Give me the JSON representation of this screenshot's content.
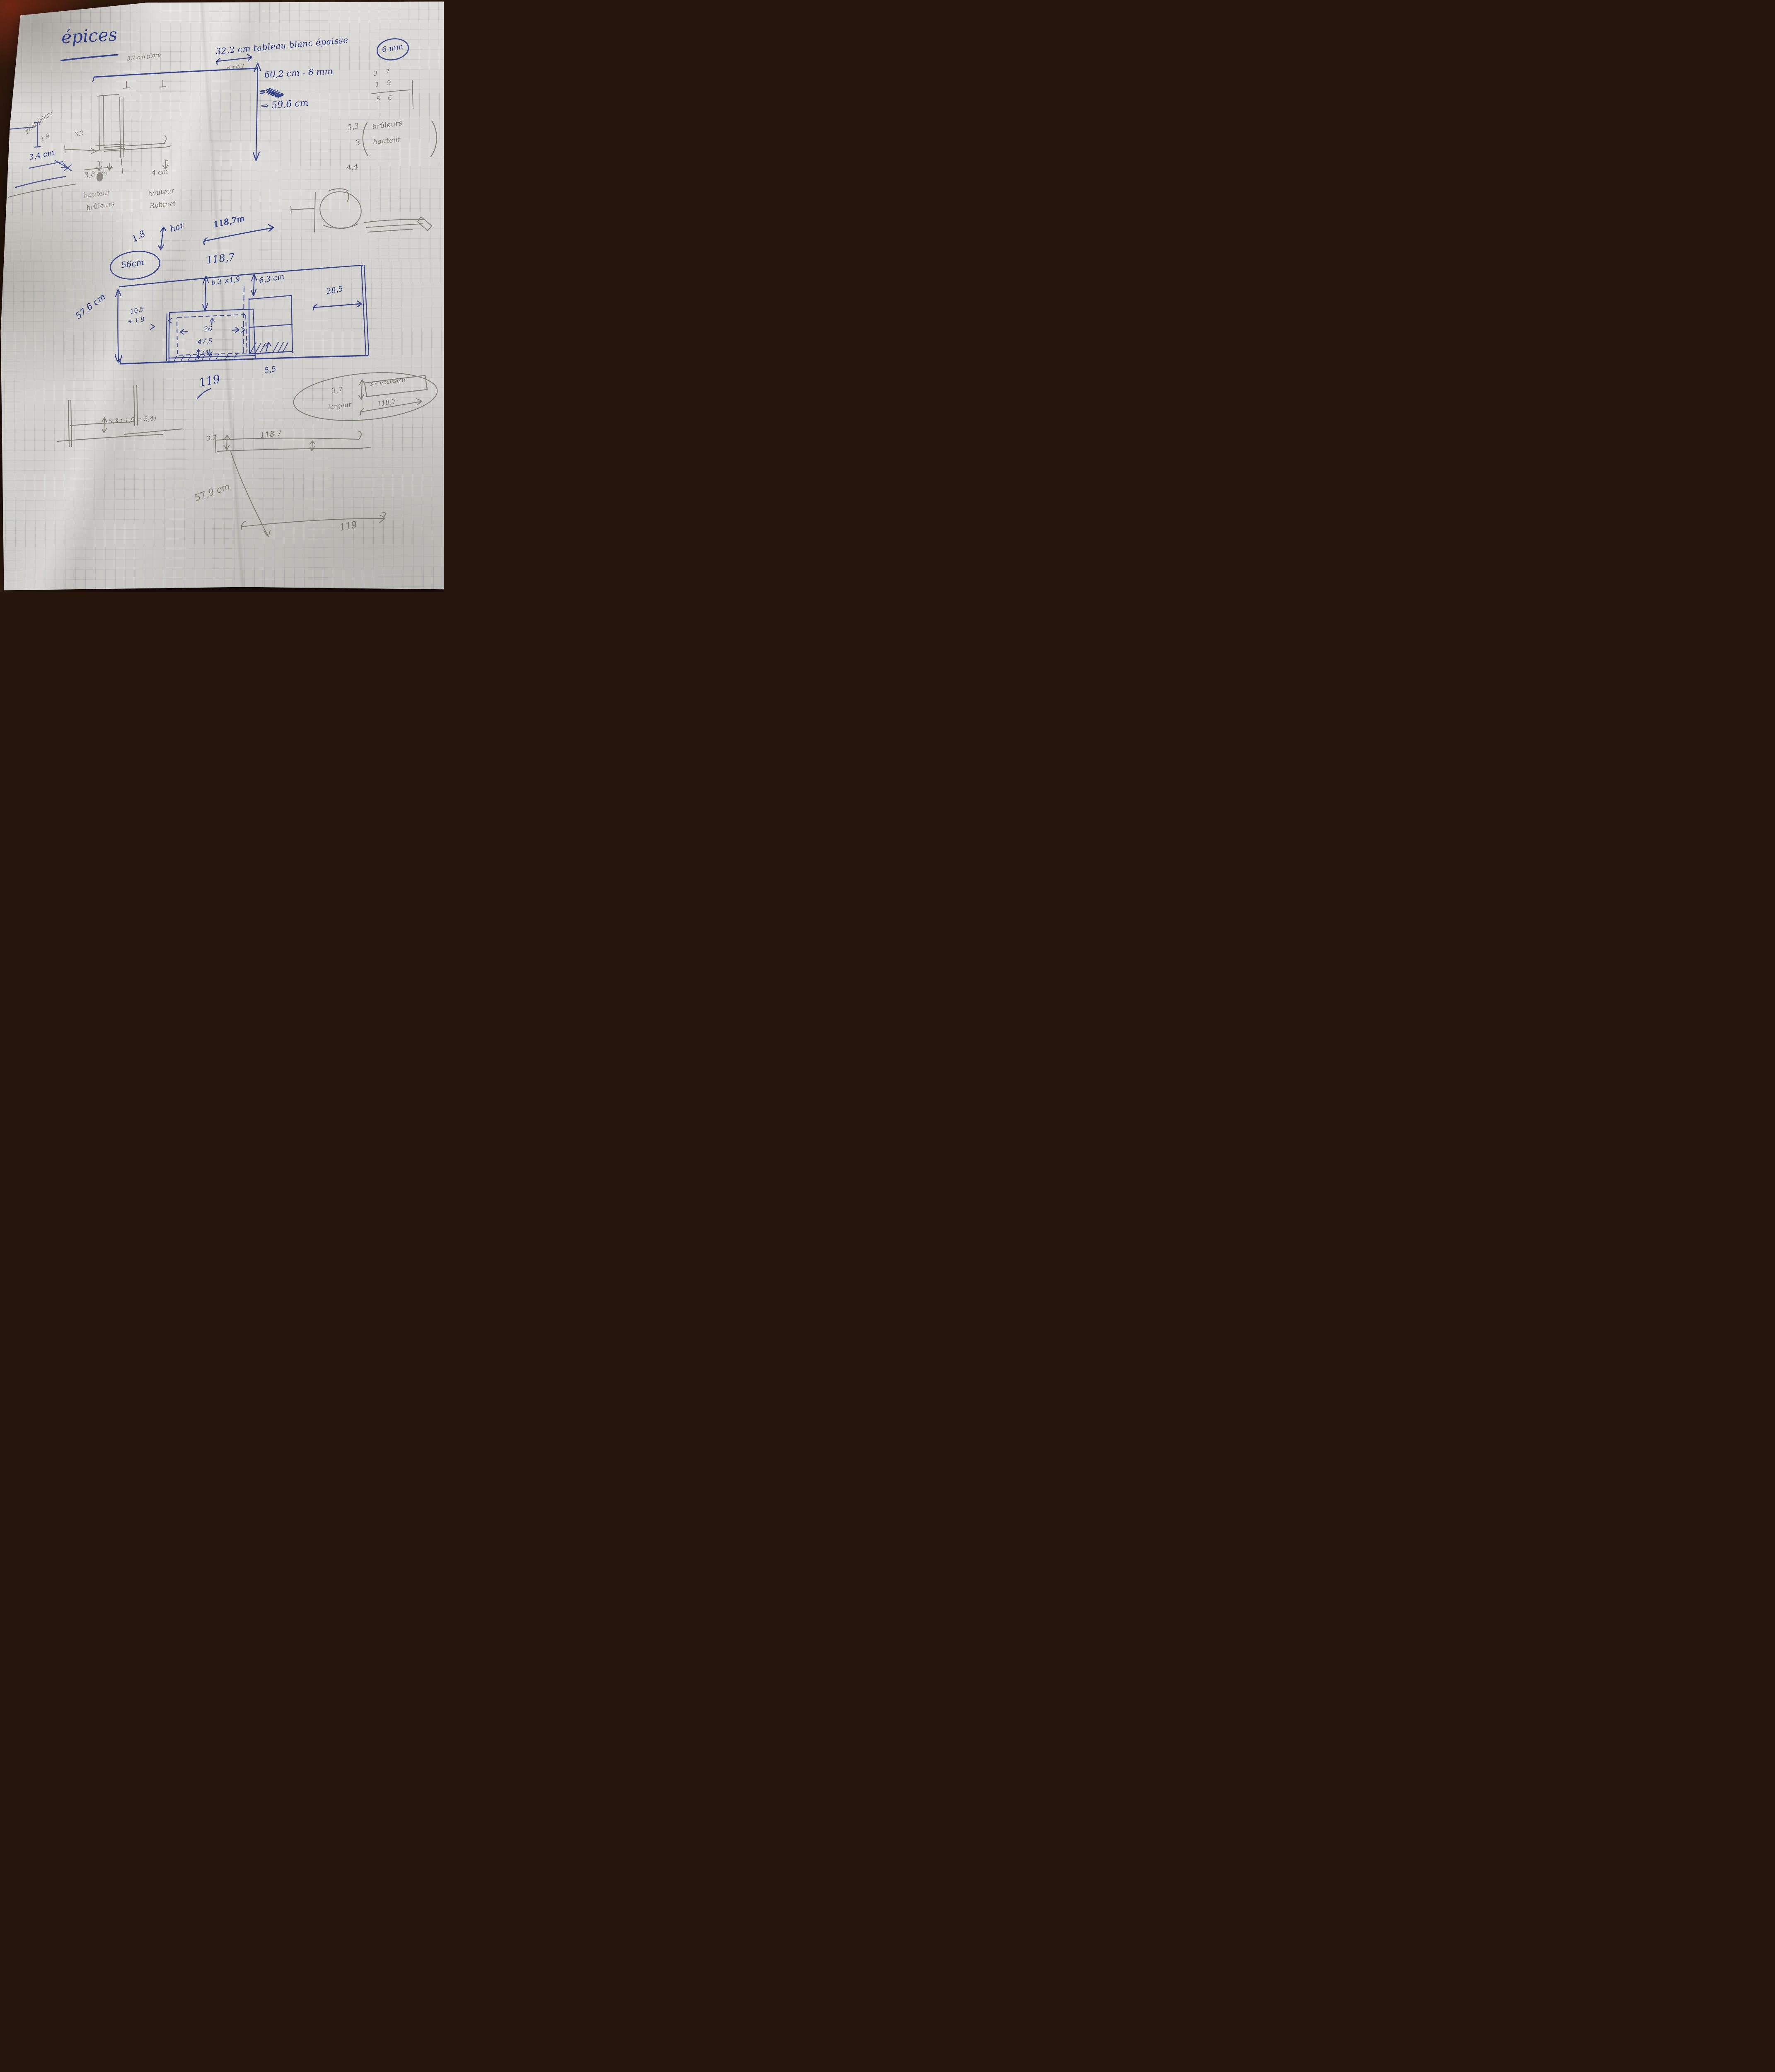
{
  "colors": {
    "ink": "#2a3784",
    "pencil": "#6b675e",
    "paper": "#d6d4d0",
    "background": "#26150c"
  },
  "title": "épices",
  "top": {
    "shelf_note": "3,7 cm plare",
    "board_note": "32,2 cm tableau blanc épaisse",
    "board_thickness": "6 mm",
    "thickness_query": "6 mm ?",
    "calc": "60,2 cm - 6 mm",
    "equals": "=",
    "result": "⇒ 59,6 cm",
    "sum_a": "3 7",
    "sum_b": "1 9",
    "sum_total": "5 6",
    "burners_value1": "3,3",
    "burners_label1": "brûleurs",
    "burners_value2": "3",
    "burners_label2": "hauteur"
  },
  "left_detail": {
    "joint_label": "joint faêtre",
    "joint_value": "1,9",
    "gap_value": "3,2",
    "edge_value": "3,4 cm",
    "burner_height": "3,8 cm",
    "burner_word1": "hauteur",
    "burner_word2": "brûleurs",
    "tap_height": "4 cm",
    "tap_word1": "hauteur",
    "tap_word2": "Robinet"
  },
  "knob": {
    "value": "4,4"
  },
  "plan": {
    "note_height": "1.8",
    "note_word": "hat",
    "note_width": "118,7m",
    "depth_circle": "56cm",
    "width_top": "118,7",
    "slot1_offset": "6,3 ×1,9",
    "slot1_left1": "10,5",
    "slot1_left2": "+ 1.9",
    "slot1_width": "26",
    "slot1_height": "47,5",
    "slot1_gap": "2,5",
    "slot2_offset": "6,3 cm",
    "slot2_right": "28,5",
    "slot2_bottom": "5,5",
    "height_left": "57,6 cm",
    "total_width": "119"
  },
  "bracket": {
    "note": "5,3 (-1,9 = 3,4)"
  },
  "edge_detail": {
    "front": "3,7",
    "thickness_box": "3,4 épaisseur",
    "width_word": "largeur",
    "width_value": "118,7"
  },
  "bottom_bar": {
    "width": "118.7",
    "height": "3.7",
    "side_height": "57,9 cm",
    "total_width": "119"
  }
}
